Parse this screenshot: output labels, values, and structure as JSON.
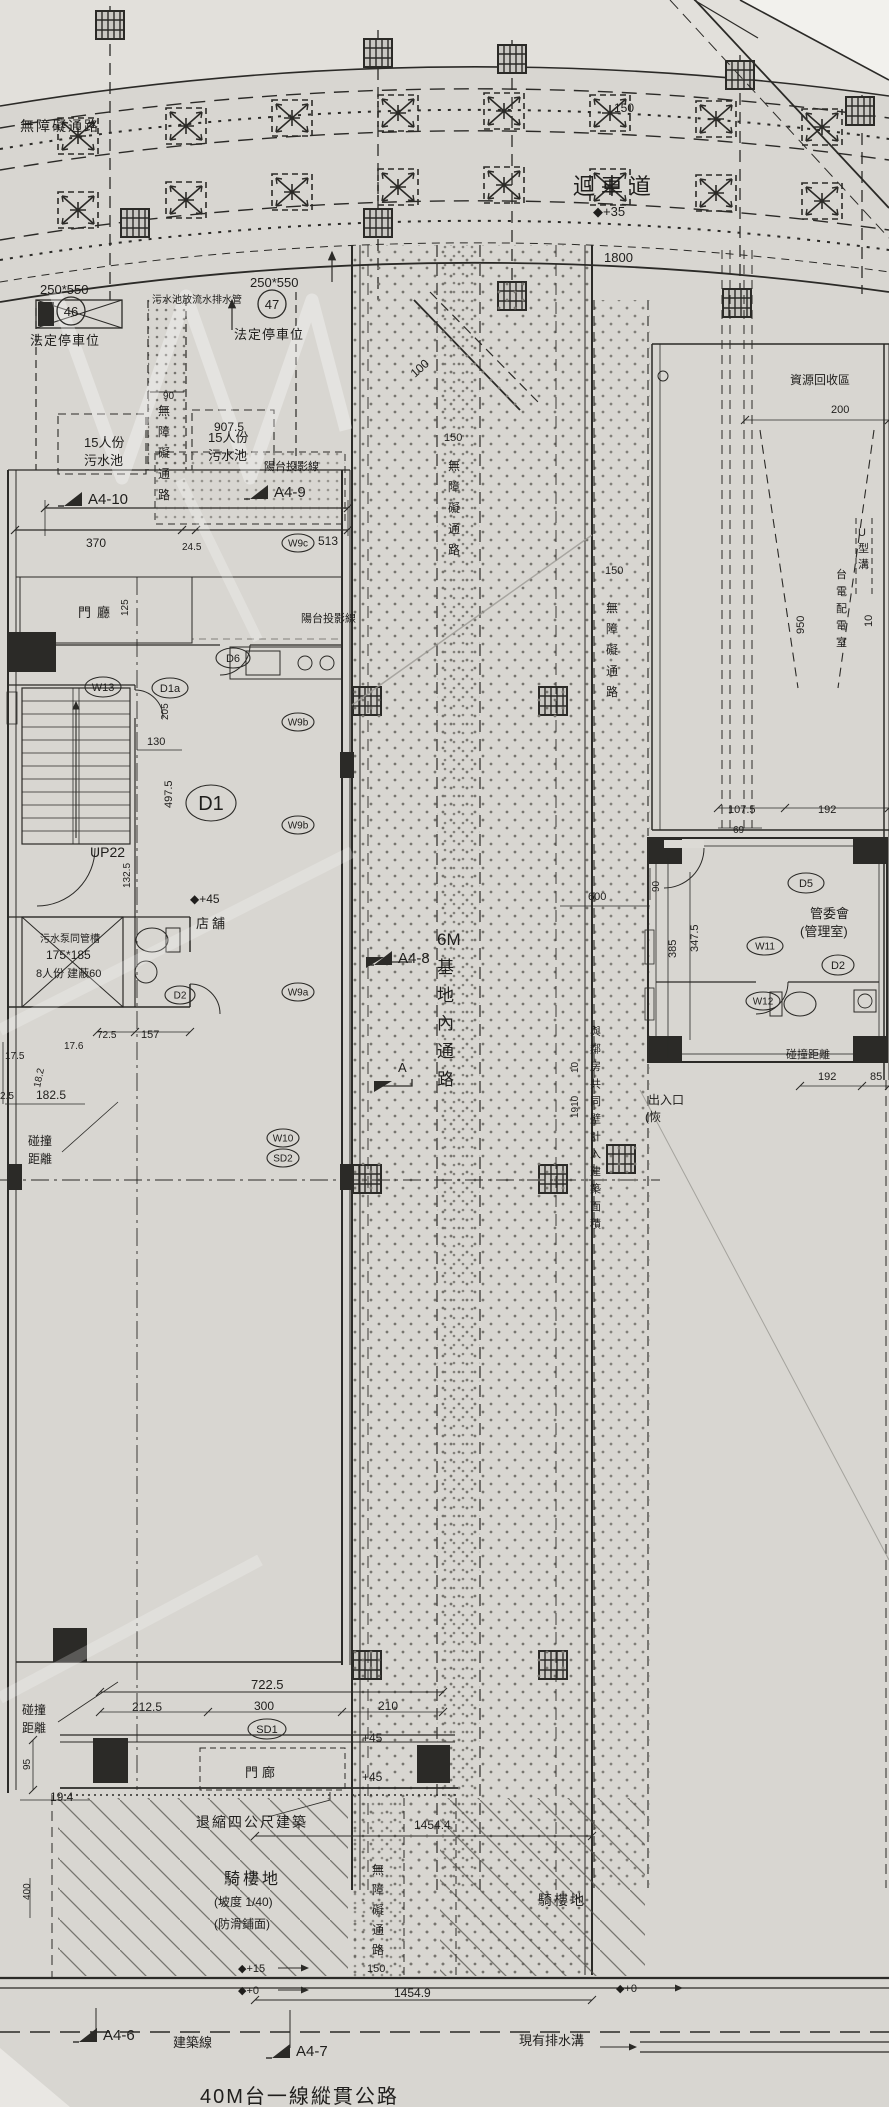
{
  "title": "建築基地配置圖 (site plan)",
  "colors": {
    "paper": "#d8d6d1",
    "ink": "#2b2a27",
    "paper_light": "#e3e1dc",
    "page_white": "#f2f1ed"
  },
  "plan": {
    "labels": [
      {
        "t": "無障礙通路",
        "x": 20,
        "y": 131,
        "s": 14,
        "ls": 2
      },
      {
        "t": "迴車道",
        "x": 573,
        "y": 194,
        "s": 22,
        "ls": 6
      },
      {
        "t": "◆+35",
        "x": 593,
        "y": 216,
        "s": 13
      },
      {
        "t": "150",
        "x": 614,
        "y": 112,
        "s": 12
      },
      {
        "t": "1800",
        "x": 604,
        "y": 262,
        "s": 13
      },
      {
        "t": "污水池放流水排水管",
        "x": 152,
        "y": 303,
        "s": 10
      },
      {
        "t": "250*550",
        "x": 40,
        "y": 294,
        "s": 13
      },
      {
        "t": "250*550",
        "x": 250,
        "y": 287,
        "s": 13
      },
      {
        "t": "法定停車位",
        "x": 30,
        "y": 345,
        "s": 13,
        "ls": 1
      },
      {
        "t": "法定停車位",
        "x": 234,
        "y": 339,
        "s": 13,
        "ls": 1
      },
      {
        "t": "90",
        "x": 163,
        "y": 399,
        "s": 10
      },
      {
        "t": "15人份",
        "x": 84,
        "y": 447,
        "s": 13
      },
      {
        "t": "污水池",
        "x": 84,
        "y": 465,
        "s": 13
      },
      {
        "t": "15人份",
        "x": 208,
        "y": 442,
        "s": 13
      },
      {
        "t": "污水池",
        "x": 208,
        "y": 460,
        "s": 13
      },
      {
        "t": "無障礙通路",
        "x": 158,
        "y": 415,
        "s": 12,
        "st": 1,
        "lh": 21
      },
      {
        "t": "907.5",
        "x": 214,
        "y": 431,
        "s": 12
      },
      {
        "t": "370",
        "x": 86,
        "y": 547,
        "s": 12
      },
      {
        "t": "24.5",
        "x": 182,
        "y": 550,
        "s": 10
      },
      {
        "t": "513",
        "x": 318,
        "y": 545,
        "s": 12
      },
      {
        "t": "100",
        "x": 415,
        "y": 378,
        "s": 12,
        "r": -42
      },
      {
        "t": "資源回收區",
        "x": 790,
        "y": 384,
        "s": 12
      },
      {
        "t": "200",
        "x": 831,
        "y": 413,
        "s": 11
      },
      {
        "t": "150",
        "x": 605,
        "y": 574,
        "s": 11
      },
      {
        "t": "無障礙通路",
        "x": 606,
        "y": 612,
        "s": 12,
        "st": 1,
        "lh": 21
      },
      {
        "t": "U型溝",
        "x": 858,
        "y": 536,
        "s": 11,
        "st": 1,
        "lh": 16
      },
      {
        "t": "台電配電室",
        "x": 836,
        "y": 578,
        "s": 11,
        "st": 1,
        "lh": 17
      },
      {
        "t": "950",
        "x": 804,
        "y": 634,
        "s": 11,
        "r": -90
      },
      {
        "t": "10",
        "x": 872,
        "y": 627,
        "s": 11,
        "r": -90
      },
      {
        "t": "107.5",
        "x": 728,
        "y": 813,
        "s": 11
      },
      {
        "t": "192",
        "x": 818,
        "y": 813,
        "s": 11
      },
      {
        "t": "69",
        "x": 733,
        "y": 833,
        "s": 10
      },
      {
        "t": "90",
        "x": 659,
        "y": 892,
        "s": 10,
        "r": -90
      },
      {
        "t": "385",
        "x": 676,
        "y": 958,
        "s": 11,
        "r": -90
      },
      {
        "t": "347.5",
        "x": 698,
        "y": 952,
        "s": 11,
        "r": -90
      },
      {
        "t": "管委會",
        "x": 810,
        "y": 918,
        "s": 13
      },
      {
        "t": "(管理室)",
        "x": 800,
        "y": 936,
        "s": 13
      },
      {
        "t": "碰撞距離",
        "x": 786,
        "y": 1058,
        "s": 11
      },
      {
        "t": "192",
        "x": 818,
        "y": 1080,
        "s": 11
      },
      {
        "t": "85",
        "x": 870,
        "y": 1080,
        "s": 11
      },
      {
        "t": "出入口",
        "x": 648,
        "y": 1104,
        "s": 12
      },
      {
        "t": "(恢",
        "x": 645,
        "y": 1121,
        "s": 12
      },
      {
        "t": "陽台投影線",
        "x": 264,
        "y": 470,
        "s": 11
      },
      {
        "t": "陽台投影線",
        "x": 301,
        "y": 622,
        "s": 11
      },
      {
        "t": "125",
        "x": 128,
        "y": 616,
        "s": 10,
        "r": -90
      },
      {
        "t": "門廳",
        "x": 78,
        "y": 617,
        "s": 13,
        "ls": 6
      },
      {
        "t": "130",
        "x": 147,
        "y": 745,
        "s": 11
      },
      {
        "t": "UP22",
        "x": 90,
        "y": 857,
        "s": 14
      },
      {
        "t": "132.5",
        "x": 130,
        "y": 888,
        "s": 10,
        "r": -90
      },
      {
        "t": "497.5",
        "x": 172,
        "y": 808,
        "s": 11,
        "r": -90
      },
      {
        "t": "205",
        "x": 168,
        "y": 720,
        "s": 10,
        "r": -90
      },
      {
        "t": "污水泵同管槽",
        "x": 40,
        "y": 942,
        "s": 10
      },
      {
        "t": "175*185",
        "x": 46,
        "y": 959,
        "s": 12
      },
      {
        "t": "8人份 建蔽60",
        "x": 36,
        "y": 977,
        "s": 11
      },
      {
        "t": "72.5",
        "x": 97,
        "y": 1038,
        "s": 10
      },
      {
        "t": "157",
        "x": 141,
        "y": 1038,
        "s": 11
      },
      {
        "t": "17.5",
        "x": 5,
        "y": 1059,
        "s": 10
      },
      {
        "t": "17.6",
        "x": 64,
        "y": 1049,
        "s": 10
      },
      {
        "t": "18.2",
        "x": 40,
        "y": 1088,
        "s": 10,
        "r": -78
      },
      {
        "t": "182.5",
        "x": 36,
        "y": 1099,
        "s": 12
      },
      {
        "t": "2.5",
        "x": 0,
        "y": 1099,
        "s": 10
      },
      {
        "t": "碰撞",
        "x": 28,
        "y": 1145,
        "s": 12
      },
      {
        "t": "距離",
        "x": 28,
        "y": 1163,
        "s": 12
      },
      {
        "t": "◆+45",
        "x": 190,
        "y": 903,
        "s": 12
      },
      {
        "t": "店舖",
        "x": 196,
        "y": 928,
        "s": 13,
        "ls": 3
      },
      {
        "t": "600",
        "x": 588,
        "y": 900,
        "s": 11
      },
      {
        "t": "6M|基|地|內|通|路",
        "x": 437,
        "y": 945,
        "s": 17,
        "st": 1,
        "lh": 28
      },
      {
        "t": "與|鄰|房|共|同|壁|計|入|建|築|面|積",
        "x": 590,
        "y": 1035,
        "s": 11,
        "st": 1,
        "lh": 17.5
      },
      {
        "t": "10",
        "x": 578,
        "y": 1073,
        "s": 10,
        "r": -90
      },
      {
        "t": "1910",
        "x": 578,
        "y": 1118,
        "s": 10,
        "r": -90
      },
      {
        "t": "A",
        "x": 398,
        "y": 1072,
        "s": 13
      },
      {
        "t": "722.5",
        "x": 251,
        "y": 1689,
        "s": 13
      },
      {
        "t": "212.5",
        "x": 132,
        "y": 1711,
        "s": 12
      },
      {
        "t": "300",
        "x": 254,
        "y": 1710,
        "s": 12
      },
      {
        "t": "210",
        "x": 378,
        "y": 1710,
        "s": 12
      },
      {
        "t": "+45",
        "x": 362,
        "y": 1742,
        "s": 12
      },
      {
        "t": "+45",
        "x": 362,
        "y": 1781,
        "s": 12
      },
      {
        "t": "門廊",
        "x": 245,
        "y": 1777,
        "s": 13,
        "ls": 4
      },
      {
        "t": "95",
        "x": 30,
        "y": 1770,
        "s": 10,
        "r": -90
      },
      {
        "t": "19.4",
        "x": 50,
        "y": 1801,
        "s": 12
      },
      {
        "t": "碰撞",
        "x": 22,
        "y": 1714,
        "s": 12
      },
      {
        "t": "距離",
        "x": 22,
        "y": 1732,
        "s": 12
      },
      {
        "t": "退縮四公尺建築",
        "x": 196,
        "y": 1827,
        "s": 14,
        "ls": 2
      },
      {
        "t": "1454.4",
        "x": 414,
        "y": 1829,
        "s": 12
      },
      {
        "t": "騎樓地",
        "x": 224,
        "y": 1884,
        "s": 16,
        "ls": 3
      },
      {
        "t": "(坡度 1/40)",
        "x": 214,
        "y": 1906,
        "s": 12
      },
      {
        "t": "(防滑鋪面)",
        "x": 214,
        "y": 1928,
        "s": 12
      },
      {
        "t": "無障礙通路",
        "x": 372,
        "y": 1874,
        "s": 12,
        "st": 1,
        "lh": 20
      },
      {
        "t": "150",
        "x": 367,
        "y": 1972,
        "s": 11
      },
      {
        "t": "騎樓地",
        "x": 538,
        "y": 1905,
        "s": 14,
        "ls": 2
      },
      {
        "t": "◆+15",
        "x": 238,
        "y": 1972,
        "s": 11
      },
      {
        "t": "◆+0",
        "x": 238,
        "y": 1994,
        "s": 11
      },
      {
        "t": "1454.9",
        "x": 394,
        "y": 1997,
        "s": 12
      },
      {
        "t": "◆+0",
        "x": 616,
        "y": 1992,
        "s": 11
      },
      {
        "t": "建築線",
        "x": 173,
        "y": 2047,
        "s": 13
      },
      {
        "t": "現有排水溝",
        "x": 519,
        "y": 2045,
        "s": 13
      },
      {
        "t": "40M台一線縱貫公路",
        "x": 200,
        "y": 2103,
        "s": 20,
        "ls": 2
      },
      {
        "t": "400",
        "x": 30,
        "y": 1900,
        "s": 10,
        "r": -90
      },
      {
        "t": "150",
        "x": 444,
        "y": 441,
        "s": 11
      },
      {
        "t": "無障礙通路",
        "x": 448,
        "y": 470,
        "s": 12,
        "st": 1,
        "lh": 21
      }
    ],
    "oval_tags": [
      {
        "t": "D6",
        "cx": 233,
        "cy": 658,
        "rx": 17,
        "ry": 10,
        "s": 11
      },
      {
        "t": "D1a",
        "cx": 170,
        "cy": 688,
        "rx": 18,
        "ry": 10,
        "s": 11
      },
      {
        "t": "W13",
        "cx": 103,
        "cy": 687,
        "rx": 18,
        "ry": 10,
        "s": 11
      },
      {
        "t": "W9c",
        "cx": 298,
        "cy": 543,
        "rx": 16,
        "ry": 9,
        "s": 10
      },
      {
        "t": "W9b",
        "cx": 298,
        "cy": 722,
        "rx": 16,
        "ry": 9,
        "s": 10
      },
      {
        "t": "W9b",
        "cx": 298,
        "cy": 825,
        "rx": 16,
        "ry": 9,
        "s": 10
      },
      {
        "t": "W9a",
        "cx": 298,
        "cy": 992,
        "rx": 16,
        "ry": 9,
        "s": 10
      },
      {
        "t": "W10",
        "cx": 283,
        "cy": 1138,
        "rx": 16,
        "ry": 9,
        "s": 10
      },
      {
        "t": "SD2",
        "cx": 283,
        "cy": 1158,
        "rx": 16,
        "ry": 9,
        "s": 10
      },
      {
        "t": "SD1",
        "cx": 267,
        "cy": 1729,
        "rx": 19,
        "ry": 10,
        "s": 11
      },
      {
        "t": "D1",
        "cx": 211,
        "cy": 803,
        "rx": 25,
        "ry": 18,
        "s": 20
      },
      {
        "t": "D5",
        "cx": 806,
        "cy": 883,
        "rx": 18,
        "ry": 10,
        "s": 11
      },
      {
        "t": "W11",
        "cx": 765,
        "cy": 946,
        "rx": 18,
        "ry": 9,
        "s": 10
      },
      {
        "t": "D2",
        "cx": 838,
        "cy": 965,
        "rx": 16,
        "ry": 10,
        "s": 11
      },
      {
        "t": "W12",
        "cx": 763,
        "cy": 1001,
        "rx": 17,
        "ry": 9,
        "s": 10
      },
      {
        "t": "D2",
        "cx": 180,
        "cy": 995,
        "rx": 15,
        "ry": 9,
        "s": 10
      }
    ],
    "circle_tags": [
      {
        "t": "46",
        "cx": 71,
        "cy": 311,
        "r": 14
      },
      {
        "t": "47",
        "cx": 272,
        "cy": 304,
        "r": 14
      }
    ],
    "section_markers": [
      {
        "t": "A4-10",
        "x": 88,
        "y": 504
      },
      {
        "t": "A4-9",
        "x": 274,
        "y": 497
      },
      {
        "t": "A4-8",
        "x": 398,
        "y": 963
      },
      {
        "t": "A4-6",
        "x": 103,
        "y": 2040
      },
      {
        "t": "A4-7",
        "x": 296,
        "y": 2056
      }
    ]
  }
}
